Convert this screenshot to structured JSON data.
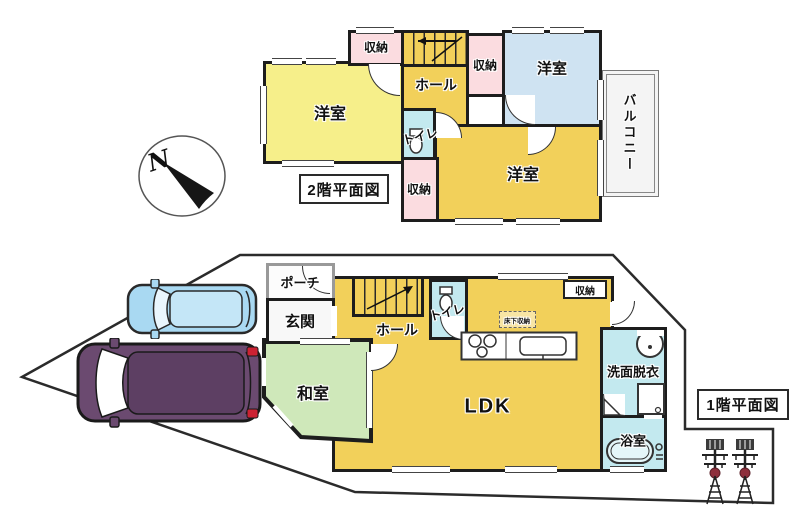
{
  "compass": {
    "label": "N"
  },
  "floor2": {
    "title": "2階平面図",
    "labels": {
      "closet_top": "収納",
      "closet_mid": "収納",
      "closet_bottom": "収納",
      "bedroom_left": "洋室",
      "bedroom_blue": "洋室",
      "bedroom_gold": "洋室",
      "hall": "ホール",
      "toilet": "トイレ",
      "balcony": "バルコニー"
    }
  },
  "floor1": {
    "title": "1階平面図",
    "labels": {
      "porch": "ポーチ",
      "entrance": "玄関",
      "hall": "ホール",
      "toilet": "トイレ",
      "tatami": "和室",
      "ldk": "LDK",
      "closet": "収納",
      "underfloor": "床下収納",
      "washroom": "洗面脱衣",
      "bath": "浴室"
    }
  },
  "colors": {
    "wall": "#1d1d1d",
    "gold_room": "#f2d05a",
    "light_yellow_room": "#f6ef8a",
    "blue_room": "#cfe3f2",
    "closet_pink": "#fbdce0",
    "wet_cyan": "#c3e9ef",
    "tatami_green": "#cfe8ba",
    "balcony_gray": "#f4f4f4",
    "car_blue": "#a9d9f2",
    "car_purple": "#6b4a70",
    "tower_red": "#8e2f3c"
  }
}
